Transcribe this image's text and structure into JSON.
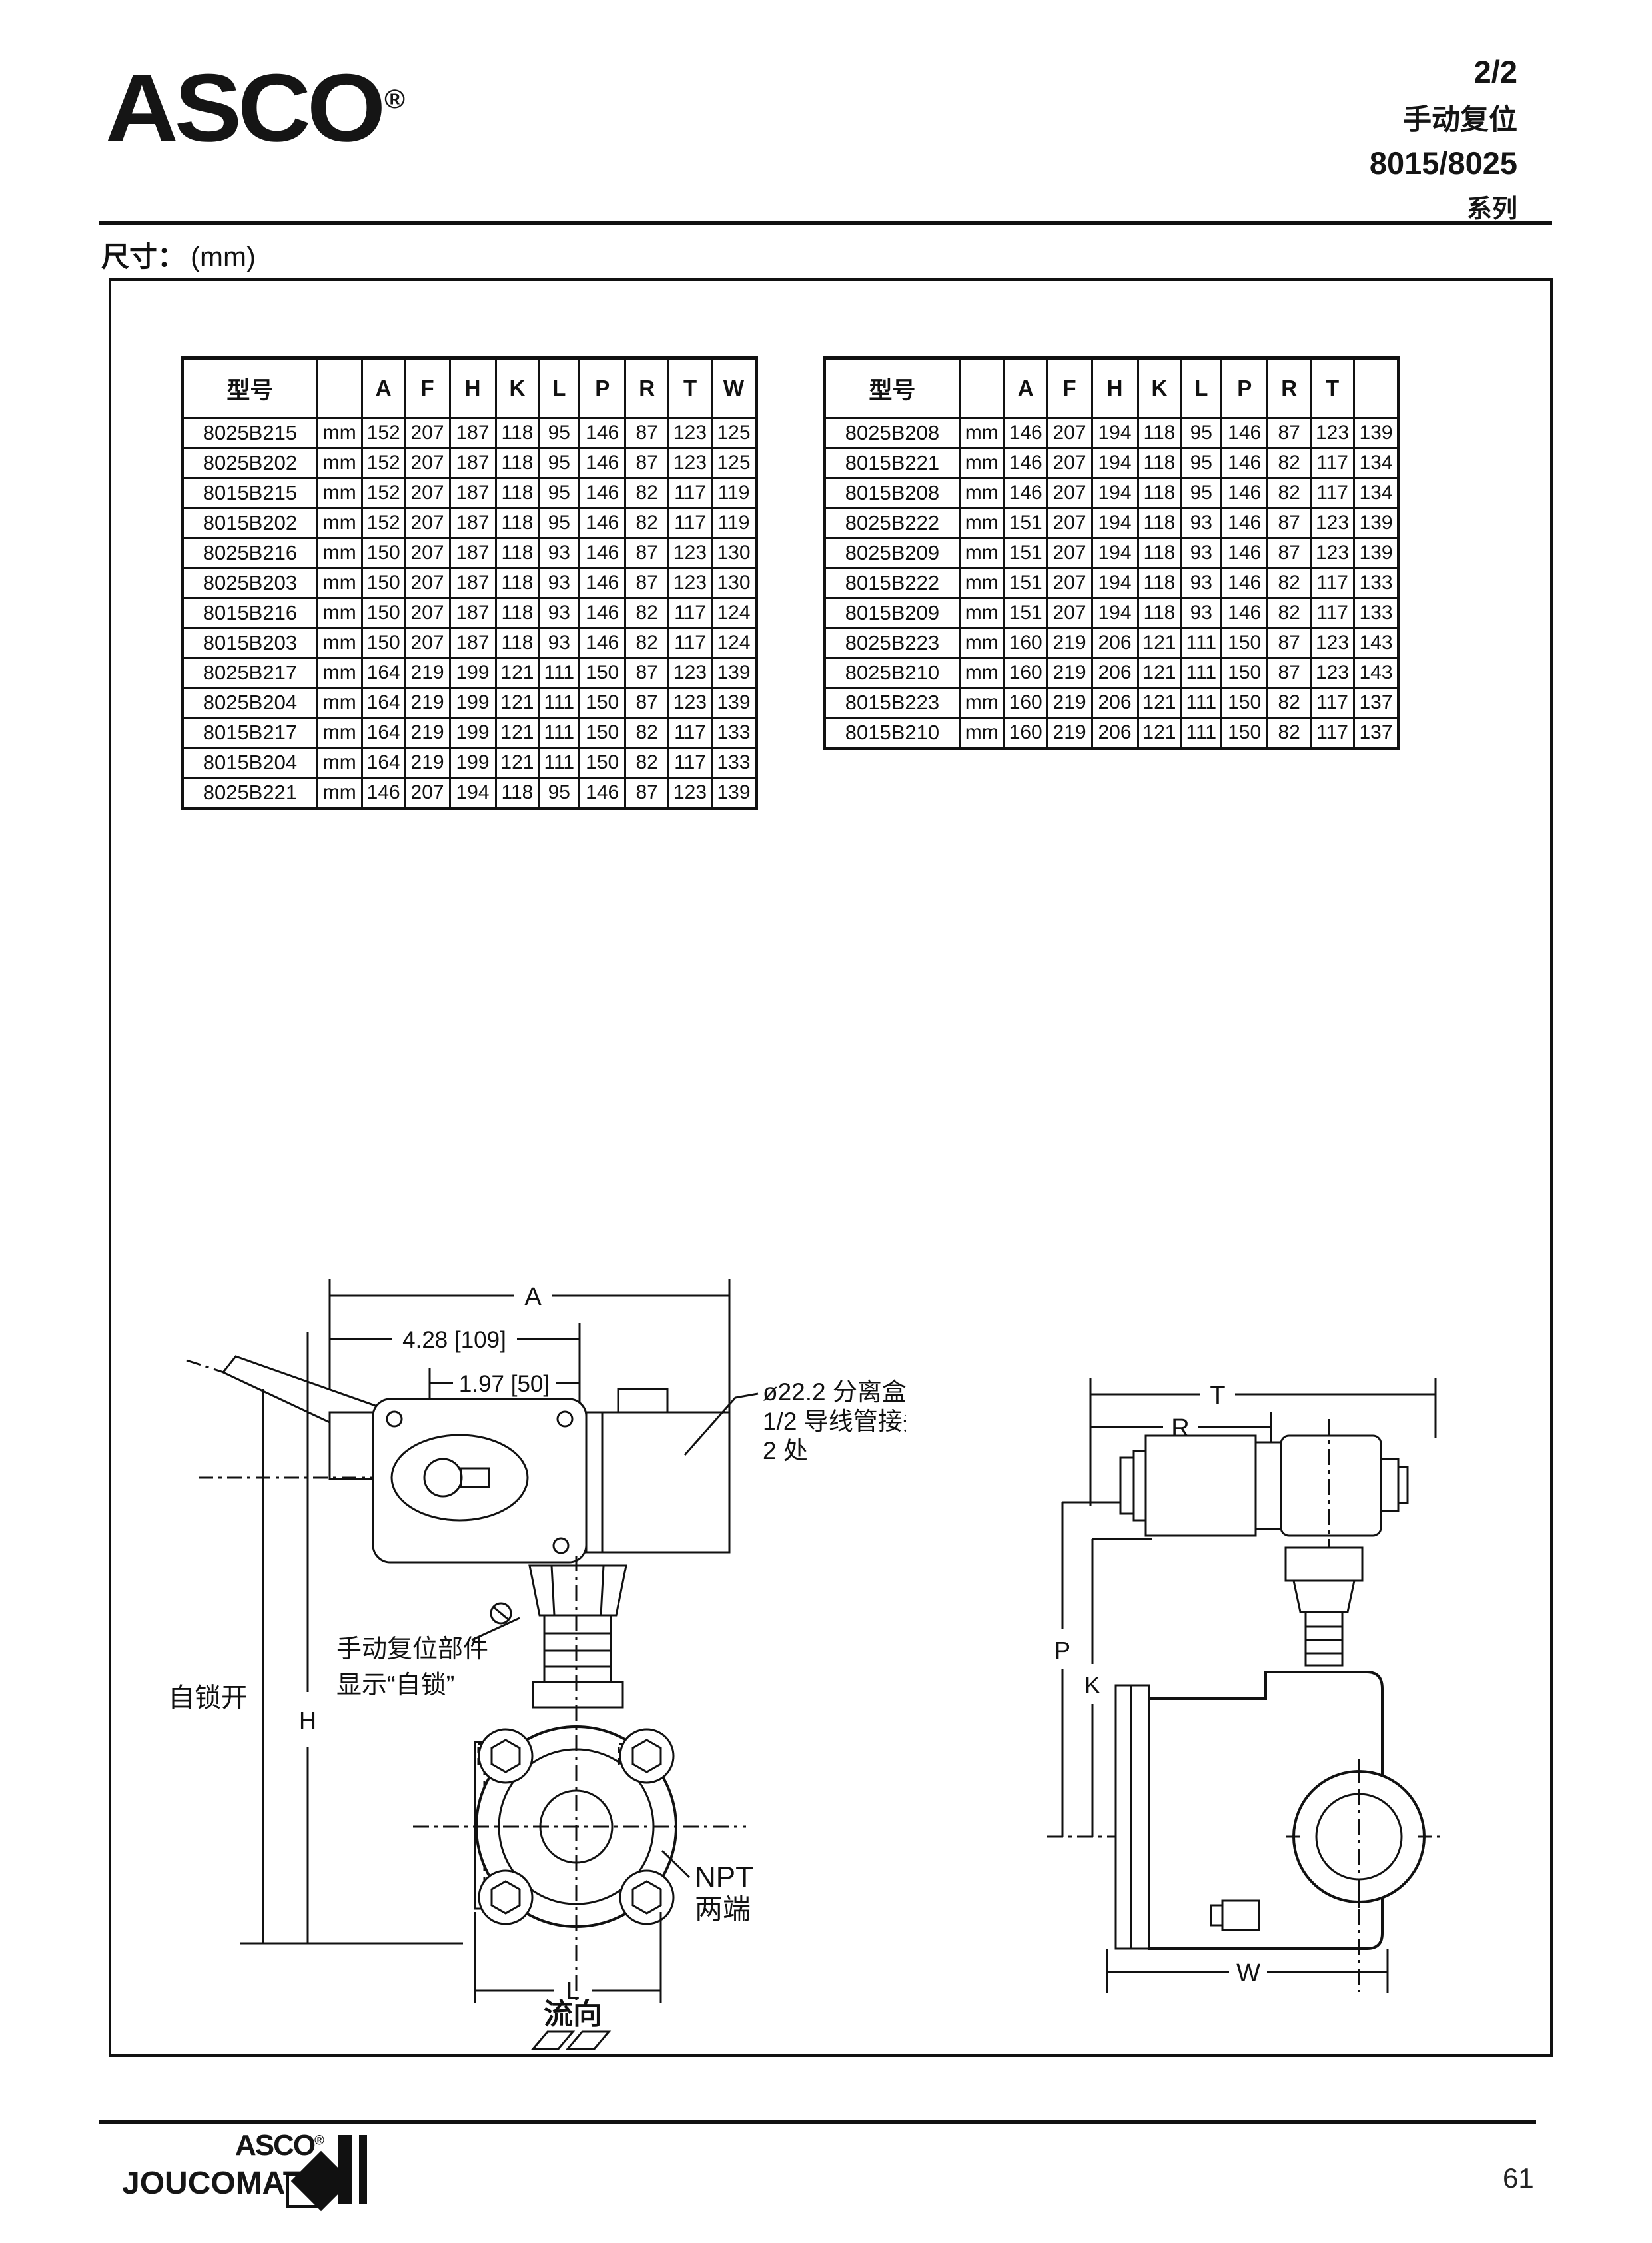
{
  "header": {
    "logo_text": "ASCO",
    "logo_reg": "®",
    "title_lines": [
      "2/2",
      "手动复位",
      "8015/8025",
      "系列"
    ]
  },
  "section": {
    "label_cn": "尺寸：",
    "label_unit": "(mm)"
  },
  "tables": {
    "left": {
      "headers": [
        "型号",
        "",
        "A",
        "F",
        "H",
        "K",
        "L",
        "P",
        "R",
        "T",
        "W"
      ],
      "rows": [
        [
          "8025B215",
          "mm",
          "152",
          "207",
          "187",
          "118",
          "95",
          "146",
          "87",
          "123",
          "125"
        ],
        [
          "8025B202",
          "mm",
          "152",
          "207",
          "187",
          "118",
          "95",
          "146",
          "87",
          "123",
          "125"
        ],
        [
          "8015B215",
          "mm",
          "152",
          "207",
          "187",
          "118",
          "95",
          "146",
          "82",
          "117",
          "119"
        ],
        [
          "8015B202",
          "mm",
          "152",
          "207",
          "187",
          "118",
          "95",
          "146",
          "82",
          "117",
          "119"
        ],
        [
          "8025B216",
          "mm",
          "150",
          "207",
          "187",
          "118",
          "93",
          "146",
          "87",
          "123",
          "130"
        ],
        [
          "8025B203",
          "mm",
          "150",
          "207",
          "187",
          "118",
          "93",
          "146",
          "87",
          "123",
          "130"
        ],
        [
          "8015B216",
          "mm",
          "150",
          "207",
          "187",
          "118",
          "93",
          "146",
          "82",
          "117",
          "124"
        ],
        [
          "8015B203",
          "mm",
          "150",
          "207",
          "187",
          "118",
          "93",
          "146",
          "82",
          "117",
          "124"
        ],
        [
          "8025B217",
          "mm",
          "164",
          "219",
          "199",
          "121",
          "111",
          "150",
          "87",
          "123",
          "139"
        ],
        [
          "8025B204",
          "mm",
          "164",
          "219",
          "199",
          "121",
          "111",
          "150",
          "87",
          "123",
          "139"
        ],
        [
          "8015B217",
          "mm",
          "164",
          "219",
          "199",
          "121",
          "111",
          "150",
          "82",
          "117",
          "133"
        ],
        [
          "8015B204",
          "mm",
          "164",
          "219",
          "199",
          "121",
          "111",
          "150",
          "82",
          "117",
          "133"
        ],
        [
          "8025B221",
          "mm",
          "146",
          "207",
          "194",
          "118",
          "95",
          "146",
          "87",
          "123",
          "139"
        ]
      ]
    },
    "right": {
      "headers": [
        "型号",
        "",
        "A",
        "F",
        "H",
        "K",
        "L",
        "P",
        "R",
        "T",
        ""
      ],
      "rows": [
        [
          "8025B208",
          "mm",
          "146",
          "207",
          "194",
          "118",
          "95",
          "146",
          "87",
          "123",
          "139"
        ],
        [
          "8015B221",
          "mm",
          "146",
          "207",
          "194",
          "118",
          "95",
          "146",
          "82",
          "117",
          "134"
        ],
        [
          "8015B208",
          "mm",
          "146",
          "207",
          "194",
          "118",
          "95",
          "146",
          "82",
          "117",
          "134"
        ],
        [
          "8025B222",
          "mm",
          "151",
          "207",
          "194",
          "118",
          "93",
          "146",
          "87",
          "123",
          "139"
        ],
        [
          "8025B209",
          "mm",
          "151",
          "207",
          "194",
          "118",
          "93",
          "146",
          "87",
          "123",
          "139"
        ],
        [
          "8015B222",
          "mm",
          "151",
          "207",
          "194",
          "118",
          "93",
          "146",
          "82",
          "117",
          "133"
        ],
        [
          "8015B209",
          "mm",
          "151",
          "207",
          "194",
          "118",
          "93",
          "146",
          "82",
          "117",
          "133"
        ],
        [
          "8025B223",
          "mm",
          "160",
          "219",
          "206",
          "121",
          "111",
          "150",
          "87",
          "123",
          "143"
        ],
        [
          "8025B210",
          "mm",
          "160",
          "219",
          "206",
          "121",
          "111",
          "150",
          "87",
          "123",
          "143"
        ],
        [
          "8015B223",
          "mm",
          "160",
          "219",
          "206",
          "121",
          "111",
          "150",
          "82",
          "117",
          "137"
        ],
        [
          "8015B210",
          "mm",
          "160",
          "219",
          "206",
          "121",
          "111",
          "150",
          "82",
          "117",
          "137"
        ]
      ]
    }
  },
  "front_view": {
    "dim_a": "A",
    "dim_top": "4.28 [109]",
    "dim_mid": "1.97 [50]",
    "conduit_note": [
      "ø22.2 分离盒适用于",
      "1/2 导线管接头",
      "2 处"
    ],
    "reset_note": [
      "手动复位部件",
      "显示“自锁”"
    ],
    "latch_label": "自锁开",
    "dim_h": "H",
    "dim_l": "L",
    "flow_label": "流向",
    "npt_note": [
      "NPT",
      "两端"
    ]
  },
  "side_view": {
    "dim_t": "T",
    "dim_r": "R",
    "dim_p": "P",
    "dim_k": "K",
    "dim_w": "W"
  },
  "footer": {
    "logo_top": "ASCO",
    "logo_reg": "®",
    "logo_bottom": "JOUCOMATIC",
    "page_number": "61"
  },
  "colors": {
    "ink": "#111111",
    "paper": "#ffffff"
  }
}
